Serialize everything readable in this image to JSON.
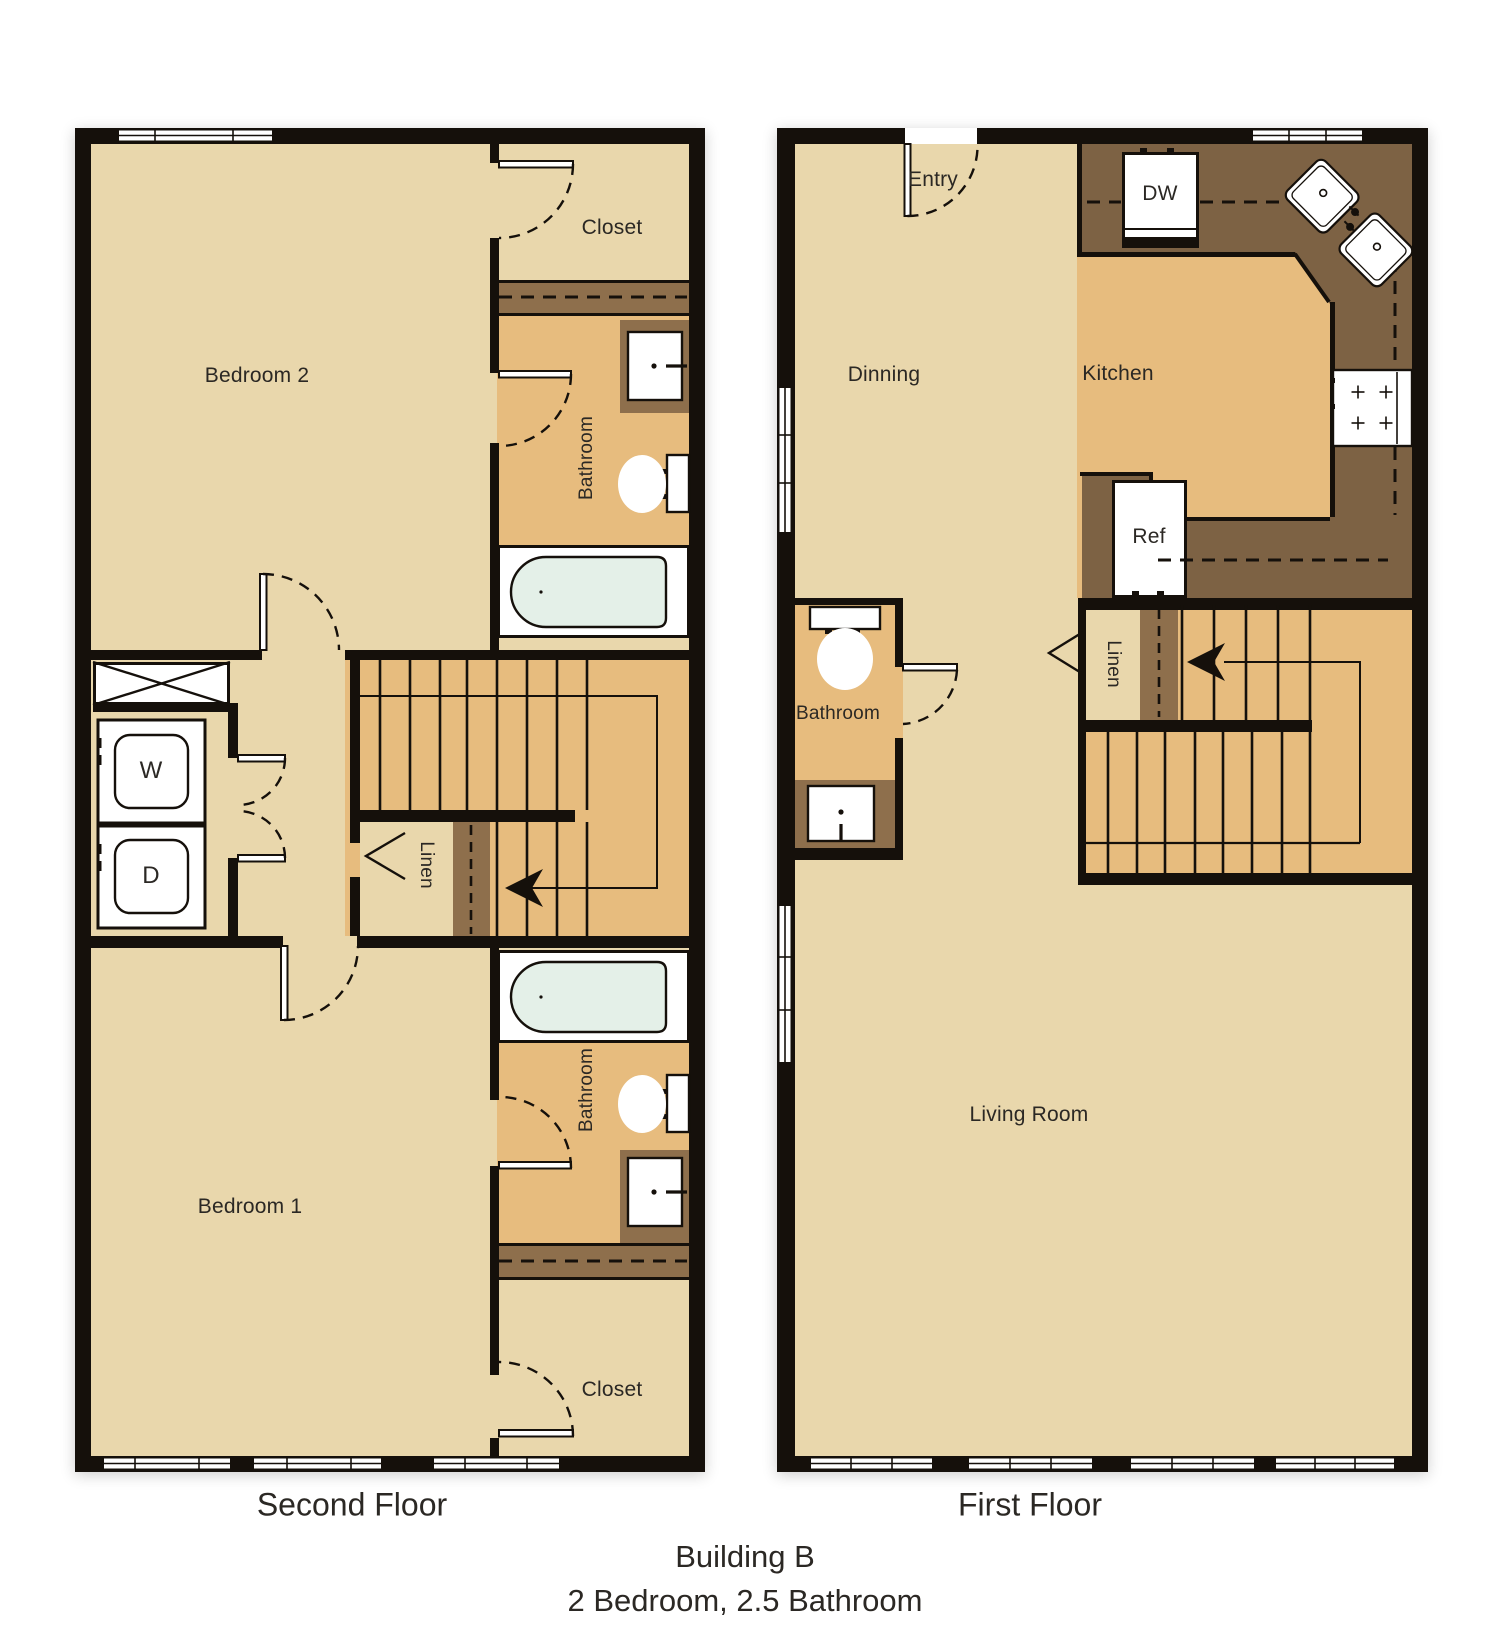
{
  "footer": {
    "building": "Building B",
    "unit": "2 Bedroom, 2.5 Bathroom"
  },
  "second_floor": {
    "label": "Second Floor",
    "bedroom2": "Bedroom 2",
    "bedroom1": "Bedroom 1",
    "closet_top": "Closet",
    "closet_bottom": "Closet",
    "bathroom_top": "Bathroom",
    "bathroom_bottom": "Bathroom",
    "linen": "Linen",
    "washer": "W",
    "dryer": "D"
  },
  "first_floor": {
    "label": "First Floor",
    "entry": "Entry",
    "dining": "Dinning",
    "kitchen": "Kitchen",
    "living_room": "Living Room",
    "bathroom": "Bathroom",
    "linen": "Linen",
    "dishwasher": "DW",
    "refrigerator": "Ref"
  },
  "colors": {
    "floor_light": "#e9d7ac",
    "floor_dark": "#e7bc7e",
    "counter_brown": "#7d6244",
    "cabinet_brown": "#8e6f4c",
    "wall_black": "#15100b",
    "tub_fill": "#e4f0e8"
  }
}
